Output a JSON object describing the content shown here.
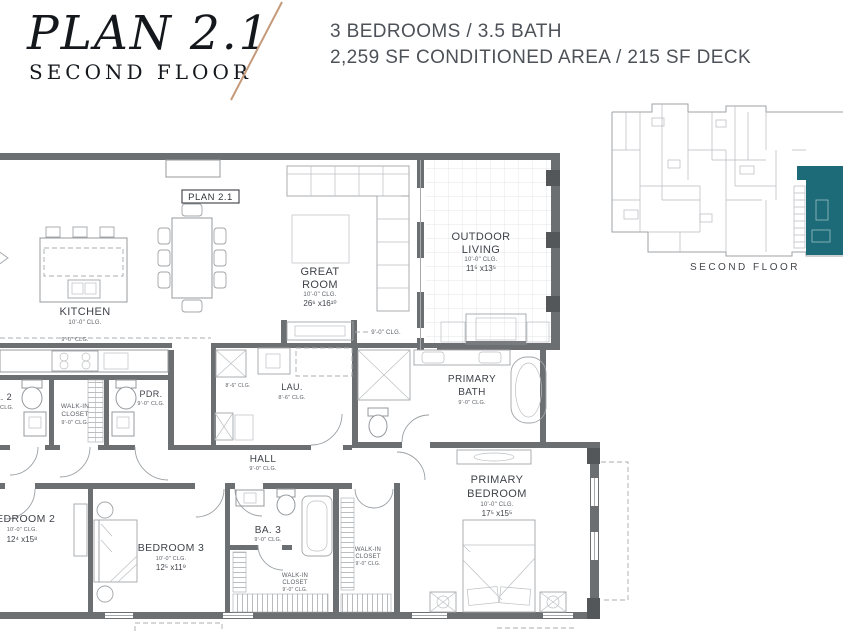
{
  "header": {
    "plan_title": "PLAN 2.1",
    "plan_subtitle": "SECOND FLOOR",
    "spec_line1": "3 BEDROOMS / 3.5 BATH",
    "spec_line2": "2,259 SF CONDITIONED AREA / 215 SF DECK",
    "accent_color": "#c49a7a"
  },
  "key_plan": {
    "caption": "SECOND FLOOR",
    "highlight_color": "#1d6b79"
  },
  "floor_plan": {
    "plan_box_label": "PLAN 2.1",
    "soffit_label_kitchen": "9'-0\" CLG.",
    "soffit_label_great": "9'-0\" CLG.",
    "soffit_label_mud": "8'-6\" CLG.",
    "rooms": {
      "kitchen": {
        "name": "KITCHEN",
        "ceiling": "10'-0\" CLG."
      },
      "great_room": {
        "line1": "GREAT",
        "line2": "ROOM",
        "ceiling": "10'-0\" CLG.",
        "dims": "26⁶ x16¹⁰"
      },
      "outdoor_living": {
        "line1": "OUTDOOR",
        "line2": "LIVING",
        "ceiling": "10'-0\" CLG.",
        "dims": "11⁵ x13⁵"
      },
      "bath2": {
        "name": "BA. 2",
        "ceiling": "9'-0\" CLG."
      },
      "walkin_bed2": {
        "line1": "WALK-IN",
        "line2": "CLOSET",
        "ceiling": "9'-0\" CLG."
      },
      "powder": {
        "name": "PDR.",
        "ceiling": "9'-0\" CLG."
      },
      "laundry": {
        "name": "LAU.",
        "ceiling": "8'-6\" CLG."
      },
      "primary_bath": {
        "line1": "PRIMARY",
        "line2": "BATH",
        "ceiling": "9'-0\" CLG."
      },
      "hall": {
        "name": "HALL",
        "ceiling": "9'-0\" CLG."
      },
      "bedroom2": {
        "name": "BEDROOM 2",
        "ceiling": "10'-0\" CLG.",
        "dims": "12⁴ x15⁸"
      },
      "bedroom3": {
        "name": "BEDROOM 3",
        "ceiling": "10'-0\" CLG.",
        "dims": "12⁵ x11⁹"
      },
      "bath3": {
        "name": "BA. 3",
        "ceiling": "9'-0\" CLG."
      },
      "walkin_bed3": {
        "line1": "WALK-IN",
        "line2": "CLOSET",
        "ceiling": "9'-0\" CLG."
      },
      "walkin_primary": {
        "line1": "WALK-IN",
        "line2": "CLOSET",
        "ceiling": "9'-0\" CLG."
      },
      "primary_bedroom": {
        "line1": "PRIMARY",
        "line2": "BEDROOM",
        "ceiling": "10'-0\" CLG.",
        "dims": "17⁵ x15⁵"
      }
    }
  }
}
